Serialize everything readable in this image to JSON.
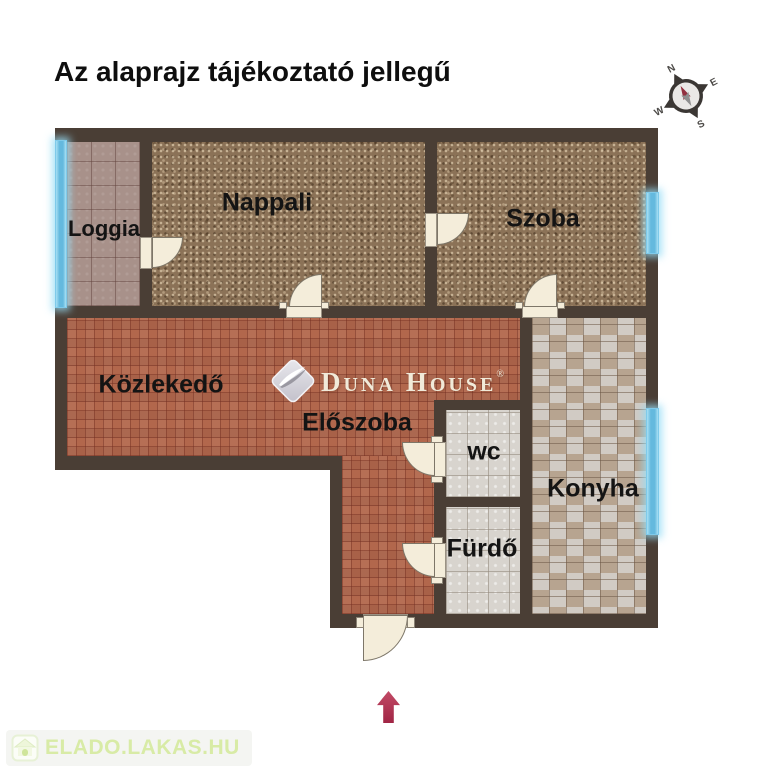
{
  "title": "Az alaprajz tájékoztató jellegű",
  "compass": {
    "north": "N",
    "east": "E",
    "south": "S",
    "west": "W"
  },
  "rooms": {
    "loggia": "Loggia",
    "nappali": "Nappali",
    "szoba": "Szoba",
    "kozlekedo": "Közlekedő",
    "eloszoba": "Előszoba",
    "wc": "wc",
    "furdo": "Fürdő",
    "konyha": "Konyha"
  },
  "logo": {
    "word1_initial": "D",
    "word1_rest": "UNA",
    "word2_initial": "H",
    "word2_rest": "OUSE",
    "registered": "®"
  },
  "watermark": {
    "label": "ELADO.LAKAS.HU"
  },
  "colors": {
    "wall": "#4a3e35",
    "carpet": "#8b7257",
    "hall_tile": "#b2674c",
    "loggia_tile": "#a8918a",
    "wet_tile": "#d8d4ce",
    "kitchen_tile_a": "#b7a490",
    "kitchen_tile_b": "#d1cbc4",
    "window": "#64b9de",
    "door": "#f4edda",
    "arrow": "#a02544",
    "logo_text": "#f1ead9",
    "watermark_green": "#d8eba6",
    "label_text": "#141414"
  }
}
